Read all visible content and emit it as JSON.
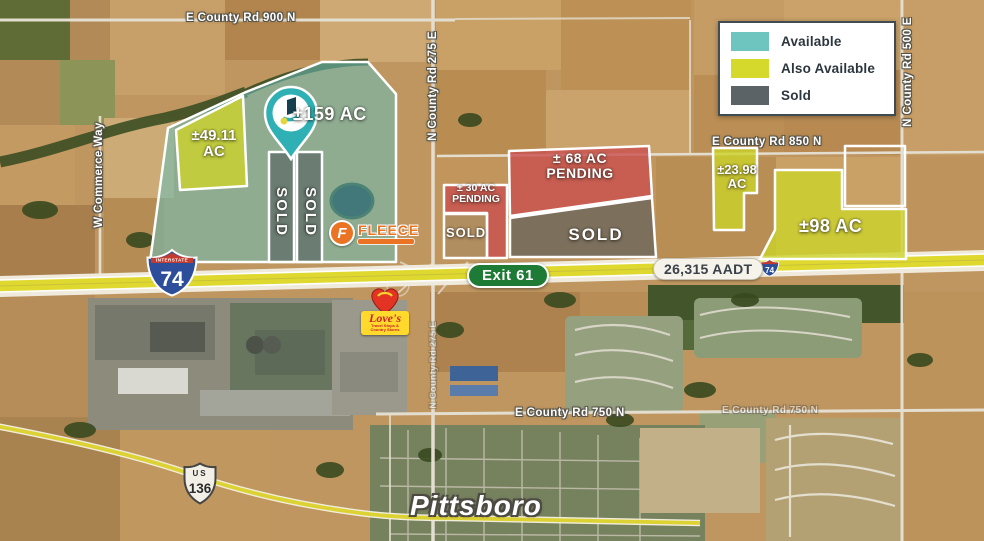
{
  "map": {
    "town": "Pittsboro",
    "exit_label": "Exit 61",
    "aadt_label": "26,315 AADT"
  },
  "legend": {
    "items": [
      {
        "label": "Available",
        "color": "#6ec5bf"
      },
      {
        "label": "Also Available",
        "color": "#d4d92b"
      },
      {
        "label": "Sold",
        "color": "#5b6367"
      }
    ]
  },
  "colors": {
    "available_fill": "#68c0ba",
    "also_available_fill": "#ccd32b",
    "sold_fill": "#4e565b",
    "pending_fill": "#c94f4f",
    "highway": "#dfd92f",
    "exit_sign_green": "#1e7b35",
    "interstate_blue": "#2d4f9b",
    "interstate_red": "#c23b31"
  },
  "roads": {
    "top": "E County Rd 900 N",
    "r850": "E County Rd 850 N",
    "r750": "E County Rd 750 N",
    "r275": "N County Rd 275 E",
    "r500": "N County Rd 500 E",
    "commerce": "W Commerce Way"
  },
  "parcels": {
    "p159": "±159 AC",
    "p49_line1": "±49.11",
    "p49_line2": "AC",
    "sold": "SOLD",
    "p30_line1": "± 30 AC",
    "p30_line2": "PENDING",
    "p68_line1": "± 68 AC",
    "p68_line2": "PENDING",
    "p2398_line1": "±23.98",
    "p2398_line2": "AC",
    "p98": "±98 AC"
  },
  "signs": {
    "interstate_label": "INTERSTATE",
    "interstate_number": "74",
    "us_label": "US",
    "us_number": "136"
  },
  "logos": {
    "fleece_initial": "F",
    "fleece_name": "FLEECE",
    "loves_name": "Love's",
    "loves_tagline": "Travel Stops & Country Stores"
  }
}
